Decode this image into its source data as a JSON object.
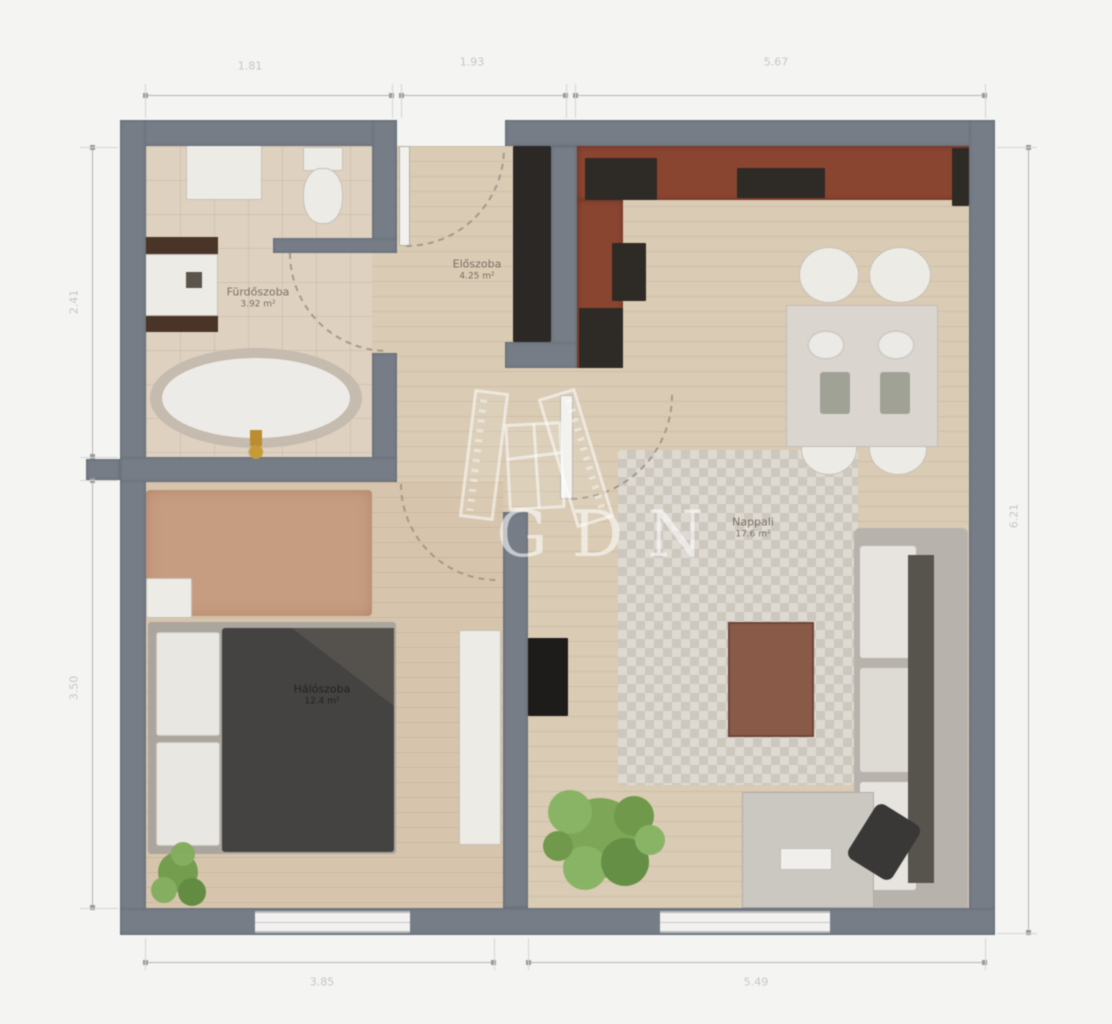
{
  "watermark": {
    "text": "GDN"
  },
  "rooms": {
    "bathroom": {
      "name": "Fürdőszoba",
      "area": "3.92 m²"
    },
    "hall": {
      "name": "Előszoba",
      "area": "4.25 m²"
    },
    "living": {
      "name": "Nappali",
      "area": "17.6 m²"
    },
    "bedroom": {
      "name": "Hálószoba",
      "area": "12.4 m²"
    }
  },
  "dimensions": {
    "top": [
      "1.81",
      "1.93",
      "5.67"
    ],
    "left": [
      "2.41",
      "3.50"
    ],
    "right": [
      "6.21"
    ],
    "bottom": [
      "3.85",
      "5.49"
    ]
  },
  "colors": {
    "wall": "#767d87",
    "wood_floor": "#d9cbb4",
    "kitchen_counter": "#8a4531",
    "bed_duvet": "#454341",
    "plant": "#79a552",
    "dimension_text": "#c7c7c7",
    "watermark": "rgba(255,255,255,0.58)"
  }
}
